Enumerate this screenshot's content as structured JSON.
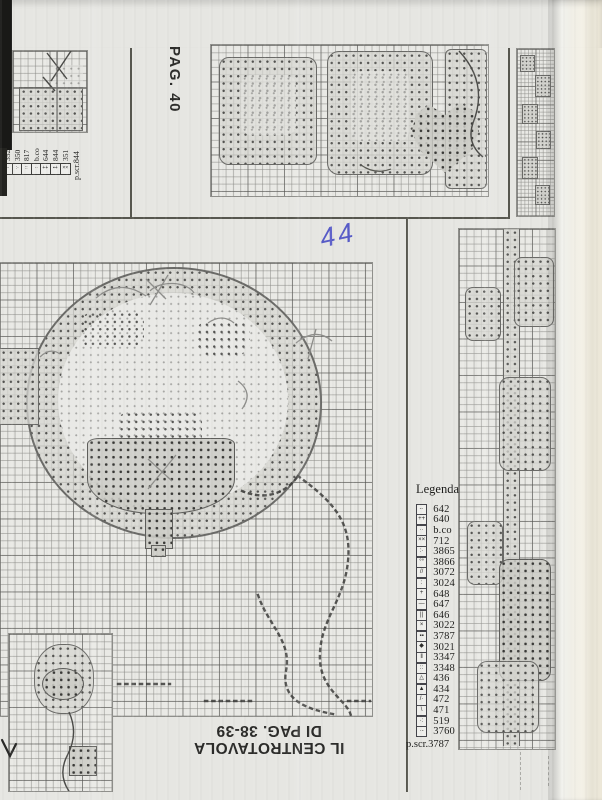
{
  "page": {
    "side_label": "PAG. 40",
    "handwritten_note": "44",
    "bottom_title": {
      "line1": "IL CENTROTAVOLA",
      "line2": "DI PAG. 38-39"
    }
  },
  "top_left_legend": {
    "items": [
      {
        "label": "352",
        "glyph": "--"
      },
      {
        "label": "350",
        "glyph": ":·"
      },
      {
        "label": "817",
        "glyph": "::"
      },
      {
        "label": "b.co",
        "glyph": "··"
      },
      {
        "label": "644",
        "glyph": "++"
      },
      {
        "label": "844",
        "glyph": "▪+"
      },
      {
        "label": "351",
        "glyph": "××"
      }
    ],
    "backstitch_label": "p.scr.844"
  },
  "main_legend": {
    "title": "Legenda",
    "items": [
      {
        "label": "642",
        "glyph": "-·"
      },
      {
        "label": "640",
        "glyph": "++"
      },
      {
        "label": "b.co",
        "glyph": "··"
      },
      {
        "label": "712",
        "glyph": "××"
      },
      {
        "label": "3865",
        "glyph": ":·"
      },
      {
        "label": "3866",
        "glyph": "°°"
      },
      {
        "label": "3072",
        "glyph": "//"
      },
      {
        "label": "3024",
        "glyph": ":"
      },
      {
        "label": "648",
        "glyph": "+"
      },
      {
        "label": "647",
        "glyph": "—"
      },
      {
        "label": "646",
        "glyph": "||"
      },
      {
        "label": "3022",
        "glyph": "×"
      },
      {
        "label": "3787",
        "glyph": "▪▪"
      },
      {
        "label": "3021",
        "glyph": "◆"
      },
      {
        "label": "3347",
        "glyph": "‖"
      },
      {
        "label": "3348",
        "glyph": "::"
      },
      {
        "label": "436",
        "glyph": "△"
      },
      {
        "label": "434",
        "glyph": "▲"
      },
      {
        "label": "472",
        "glyph": "/·"
      },
      {
        "label": "471",
        "glyph": "\\"
      },
      {
        "label": "519",
        "glyph": "·:"
      },
      {
        "label": "3760",
        "glyph": "·-"
      }
    ],
    "backstitch_label": "p.scr.3787"
  },
  "colors": {
    "paper": "#e6e6e2",
    "scanner_band_gray": "#a4a4a1",
    "scan_strip_black": "#1a1a1a",
    "grid_line": "#9a9a97",
    "stitch_ink": "#3f3f3d",
    "handwriting_blue": "#575bc7"
  }
}
